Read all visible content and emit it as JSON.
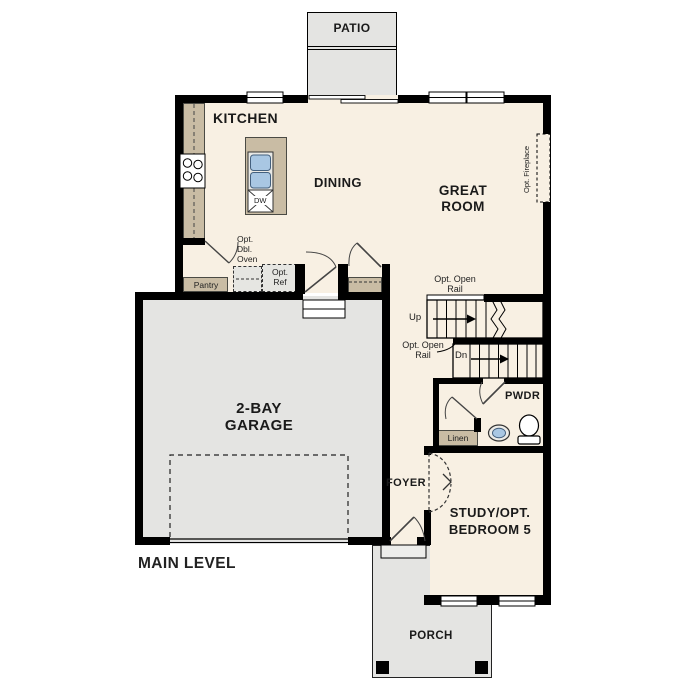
{
  "plan": {
    "level_label": "MAIN LEVEL"
  },
  "rooms": {
    "patio": {
      "label": "PATIO"
    },
    "kitchen": {
      "label": "KITCHEN"
    },
    "dining": {
      "label": "DINING"
    },
    "great_room": {
      "line1": "GREAT",
      "line2": "ROOM"
    },
    "garage": {
      "line1": "2-BAY",
      "line2": "GARAGE"
    },
    "foyer": {
      "label": "FOYER"
    },
    "powder": {
      "label": "PWDR"
    },
    "study": {
      "line1": "STUDY/OPT.",
      "line2": "BEDROOM 5"
    },
    "porch": {
      "label": "PORCH"
    }
  },
  "features": {
    "pantry": "Pantry",
    "linen": "Linen",
    "dishwasher": "DW",
    "opt_double_oven": {
      "line1": "Opt.",
      "line2": "Dbl.",
      "line3": "Oven"
    },
    "opt_ref": {
      "line1": "Opt.",
      "line2": "Ref"
    },
    "opt_fireplace": "Opt. Fireplace",
    "opt_open_rail_upper": {
      "line1": "Opt. Open",
      "line2": "Rail"
    },
    "opt_open_rail_lower": {
      "line1": "Opt. Open",
      "line2": "Rail"
    },
    "stairs_up": "Up",
    "stairs_down": "Dn"
  },
  "colors": {
    "floor": "#f8f0e3",
    "hardscape": "#e4e4e2",
    "cabinetry": "#c9bca4",
    "sink_fixture": "#a9c7e3",
    "wall": "#000000"
  }
}
